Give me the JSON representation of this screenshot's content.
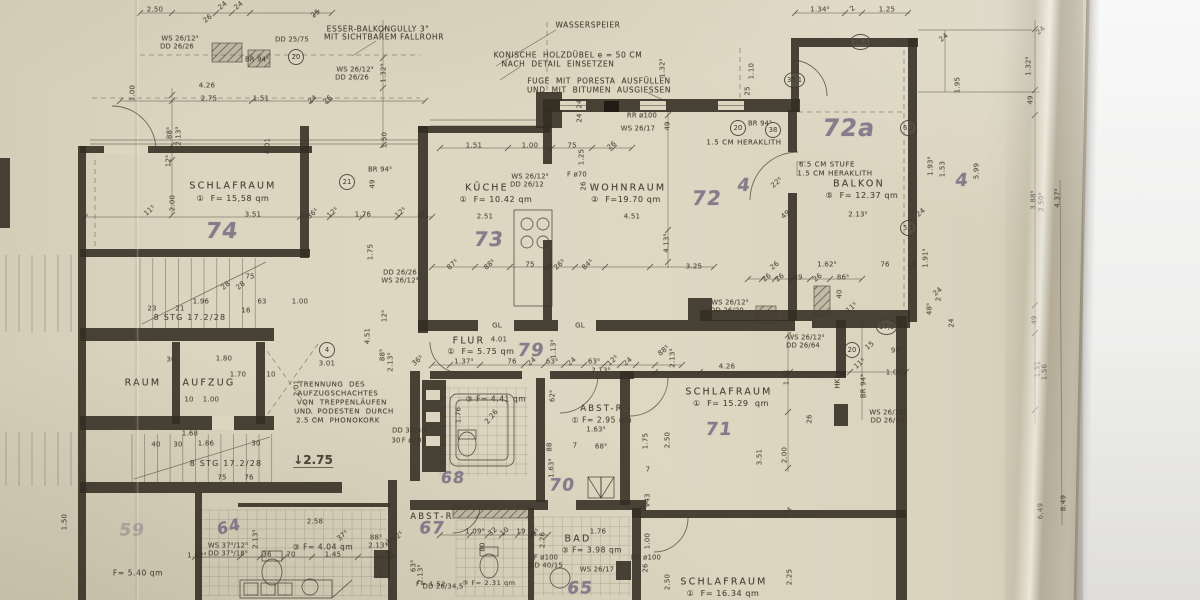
{
  "meta": {
    "title": "Grundriss — photographed hand-drawn German floor plan sheet (Obergeschoss apartment)"
  },
  "colors": {
    "paper": "#dcd5c0",
    "ink": "#3e372c",
    "pencil": "#6d647d",
    "background": "#efefee"
  },
  "rooms": [
    {
      "name": "SCHLAFRAUM",
      "index": "1",
      "area": "F= 15,58 qm",
      "pencil_no": "74"
    },
    {
      "name": "KÜCHE",
      "index": "1",
      "area": "F= 10.42 qm",
      "pencil_no": "73"
    },
    {
      "name": "WOHNRAUM",
      "index": "2",
      "area": "F= 19.70 qm",
      "pencil_no": "72"
    },
    {
      "name": "BALKON",
      "index": "5",
      "area": "F= 12.37 qm",
      "pencil_no": "72a"
    },
    {
      "name": "FLUR",
      "index": "1",
      "area": "F= 5.75 qm",
      "pencil_no": "79"
    },
    {
      "name": "SCHLAFRAUM",
      "index": "1",
      "area": "F= 15.29 qm",
      "pencil_no": "71"
    },
    {
      "name": "ABST-R",
      "index": "1",
      "area": "F= 2.95 qm",
      "pencil_no": ""
    },
    {
      "name": "BAD",
      "index": "3",
      "area": "F= 3.98 qm",
      "pencil_no": "65"
    },
    {
      "name": "SCHLAFRAUM",
      "index": "1",
      "area": "F= 16.34 qm",
      "pencil_no": ""
    },
    {
      "name": "AUFZUG",
      "index": "",
      "area": "",
      "pencil_no": ""
    },
    {
      "name": "RAUM",
      "index": "",
      "area": "",
      "pencil_no": ""
    },
    {
      "name": "ABST-R",
      "index": "",
      "area": "",
      "pencil_no": "67"
    },
    {
      "name": "BAD",
      "index": "3",
      "area": "F= 4.04 qm",
      "pencil_no": "64"
    }
  ],
  "labels": [
    [
      "ESSER-BALKONGULLY 3\"",
      378,
      29,
      0,
      7.5,
      "n"
    ],
    [
      "MIT SICHTBAREM FALLROHR",
      384,
      37,
      0,
      7.5,
      "n"
    ],
    [
      "WASSERSPEIER",
      588,
      25,
      0,
      7.5,
      "n"
    ],
    [
      "KONISCHE  HOLZDÜBEL e = 50 CM",
      568,
      55,
      0,
      7.5,
      "n"
    ],
    [
      "NACH  DETAIL  EINSETZEN",
      558,
      64,
      0,
      7.5,
      "n"
    ],
    [
      "FUGE  MIT  PORESTA  AUSFÜLLEN",
      599,
      81,
      0,
      7.5,
      "n"
    ],
    [
      "UND  MIT  BITUMEN  AUSGIESSEN",
      599,
      90,
      0,
      7.5,
      "n"
    ],
    [
      "1.5 CM HERAKLITH",
      744,
      143,
      0,
      7,
      "n"
    ],
    [
      "6.5 CM STUFE",
      827,
      165,
      0,
      7,
      "n"
    ],
    [
      "1.5 CM HERAKLITH",
      835,
      174,
      0,
      7,
      "n"
    ],
    [
      "TRENNUNG  DES",
      332,
      385,
      0,
      7,
      "n"
    ],
    [
      "AUFZUGSCHACHTES",
      338,
      394,
      0,
      7,
      "n"
    ],
    [
      "VON  TREPPENLÄUFEN",
      342,
      403,
      0,
      7,
      "n"
    ],
    [
      "UND  PODESTEN  DURCH",
      344,
      412,
      0,
      7,
      "n"
    ],
    [
      "2.5 CM  PHONOKORK",
      338,
      421,
      0,
      7,
      "n"
    ],
    [
      "WS 26/12⁵",
      180,
      39,
      0,
      6.8,
      "w"
    ],
    [
      "DD 26/26",
      177,
      47,
      0,
      6.8,
      "w"
    ],
    [
      "DD 25/75",
      292,
      40,
      0,
      6.8,
      "w"
    ],
    [
      "BR 94⁵",
      257,
      60,
      0,
      6.8,
      "w"
    ],
    [
      "WS 26/12⁵",
      355,
      70,
      0,
      6.8,
      "w"
    ],
    [
      "DD 26/26",
      352,
      78,
      0,
      6.8,
      "w"
    ],
    [
      "WS 26/12⁵",
      530,
      177,
      0,
      6.8,
      "w"
    ],
    [
      "DD 26/12",
      527,
      185,
      0,
      6.8,
      "w"
    ],
    [
      "F ø70",
      577,
      175,
      0,
      6.8,
      "w"
    ],
    [
      "RR ø100",
      642,
      116,
      0,
      6.8,
      "w"
    ],
    [
      "WS 26/17",
      638,
      129,
      0,
      6.8,
      "w"
    ],
    [
      "BR 94⁵",
      760,
      124,
      0,
      6.8,
      "w"
    ],
    [
      "BR 94⁵",
      380,
      170,
      0,
      6.8,
      "w"
    ],
    [
      "WS 26/12⁵",
      730,
      303,
      0,
      6.8,
      "w"
    ],
    [
      "DD 26/20",
      727,
      311,
      0,
      6.8,
      "w"
    ],
    [
      "WS 26/12⁵",
      806,
      338,
      0,
      6.8,
      "w"
    ],
    [
      "DD 26/64",
      803,
      346,
      0,
      6.8,
      "w"
    ],
    [
      "WS 26/12⁵",
      888,
      413,
      0,
      6.8,
      "w"
    ],
    [
      "DD 26/18⁵",
      889,
      421,
      0,
      6.8,
      "w"
    ],
    [
      "DD 26/26",
      400,
      273,
      0,
      6.8,
      "w"
    ],
    [
      "WS 26/12⁵",
      400,
      281,
      0,
      6.8,
      "w"
    ],
    [
      "DD 30/40",
      409,
      431,
      0,
      6.8,
      "w"
    ],
    [
      "30",
      396,
      441,
      0,
      6.8,
      "w"
    ],
    [
      "F ø100",
      414,
      441,
      0,
      6.8,
      "w"
    ],
    [
      "WS 37⁵/12⁵",
      228,
      546,
      0,
      6.8,
      "w"
    ],
    [
      "DD 37⁵/18⁵",
      228,
      554,
      0,
      6.8,
      "w"
    ],
    [
      "DD 26/34,5",
      443,
      587,
      0,
      6.8,
      "w"
    ],
    [
      "F ø100",
      546,
      558,
      0,
      6.8,
      "w"
    ],
    [
      "DD 40/15",
      546,
      566,
      0,
      6.8,
      "w"
    ],
    [
      "WS 26/17",
      597,
      570,
      0,
      6.8,
      "w"
    ],
    [
      "RR ø100",
      646,
      558,
      0,
      6.8,
      "w"
    ],
    [
      "HKN",
      838,
      381,
      -90,
      6.8,
      "w"
    ],
    [
      "BR 94⁵",
      864,
      386,
      -90,
      6.8,
      "w"
    ],
    [
      "GL",
      497,
      326,
      0,
      7,
      "w"
    ],
    [
      "GL",
      580,
      326,
      0,
      7,
      "w"
    ],
    [
      "8 STG 17.2/28",
      190,
      318,
      0,
      8,
      "stg"
    ],
    [
      "8 STG 17.2/28",
      226,
      464,
      0,
      8,
      "stg"
    ],
    [
      "↓2.75",
      313,
      461,
      0,
      12,
      "lvl"
    ],
    [
      "SCHLAFRAUM",
      233,
      186,
      0,
      9.5,
      "room"
    ],
    [
      "①  F= 15,58 qm",
      233,
      199,
      0,
      8,
      "area"
    ],
    [
      "KÜCHE",
      487,
      188,
      0,
      9.5,
      "room"
    ],
    [
      "①  F= 10.42 qm",
      496,
      200,
      0,
      8,
      "area"
    ],
    [
      "WOHNRAUM",
      628,
      188,
      0,
      9.5,
      "room"
    ],
    [
      "②  F=19.70 qm",
      626,
      200,
      0,
      8,
      "area"
    ],
    [
      "BALKON",
      859,
      184,
      0,
      9.5,
      "room"
    ],
    [
      "⑤  F= 12.37 qm",
      862,
      196,
      0,
      8,
      "area"
    ],
    [
      "FLUR",
      469,
      341,
      0,
      9.5,
      "room"
    ],
    [
      "①  F= 5.75 qm",
      481,
      352,
      0,
      8,
      "area"
    ],
    [
      "③ F= 4.41 qm",
      496,
      399,
      0,
      7.5,
      "area"
    ],
    [
      "ABST-R",
      602,
      409,
      0,
      8.5,
      "room"
    ],
    [
      "① F= 2.95 qm",
      602,
      420,
      0,
      7.5,
      "area"
    ],
    [
      "SCHLAFRAUM",
      729,
      392,
      0,
      9.5,
      "room"
    ],
    [
      "①  F= 15.29  qm",
      731,
      404,
      0,
      8,
      "area"
    ],
    [
      "RAUM",
      143,
      383,
      0,
      9.5,
      "room"
    ],
    [
      "AUFZUG",
      209,
      383,
      0,
      9.5,
      "room"
    ],
    [
      "ABST-R",
      432,
      517,
      0,
      8.5,
      "room"
    ],
    [
      "BAD",
      578,
      539,
      0,
      9.5,
      "room"
    ],
    [
      "③ F= 3.98 qm",
      592,
      550,
      0,
      7.5,
      "area"
    ],
    [
      "SCHLAFRAUM",
      724,
      582,
      0,
      9.5,
      "room"
    ],
    [
      "①  F= 16.34 qm",
      723,
      594,
      0,
      8,
      "area"
    ],
    [
      "③ F= 2.31 qm",
      489,
      583,
      0,
      6.5,
      "area"
    ],
    [
      "③ F= 4.04 qm",
      323,
      547,
      0,
      7.5,
      "area"
    ],
    [
      "F= 5.40 qm",
      138,
      573,
      0,
      7.5,
      "area"
    ],
    [
      "F= 1.52",
      431,
      584,
      0,
      6.5,
      "area"
    ],
    [
      "74",
      222,
      232,
      0,
      22,
      "hw"
    ],
    [
      "73",
      489,
      239,
      0,
      20,
      "hw"
    ],
    [
      "72",
      707,
      198,
      0,
      20,
      "hw"
    ],
    [
      "72a",
      849,
      128,
      0,
      24,
      "hw"
    ],
    [
      "79",
      531,
      351,
      0,
      18,
      "hw"
    ],
    [
      "71",
      719,
      430,
      0,
      18,
      "hw"
    ],
    [
      "70",
      562,
      486,
      0,
      17,
      "hw"
    ],
    [
      "68",
      453,
      478,
      0,
      16,
      "hw"
    ],
    [
      "67",
      432,
      529,
      0,
      17,
      "hw"
    ],
    [
      "65",
      580,
      589,
      0,
      17,
      "hw"
    ],
    [
      "64",
      229,
      527,
      -14,
      16,
      "hw"
    ],
    [
      "59",
      132,
      531,
      0,
      17,
      "hw2"
    ],
    [
      "4",
      744,
      186,
      0,
      18,
      "hw"
    ],
    [
      "4",
      962,
      181,
      0,
      18,
      "hw"
    ],
    [
      "2.50",
      155,
      10
    ],
    [
      "26",
      208,
      19,
      -40
    ],
    [
      "24",
      223,
      6,
      -40
    ],
    [
      "24",
      239,
      6,
      -40
    ],
    [
      "25",
      316,
      14,
      -40
    ],
    [
      "1.32⁵",
      384,
      73,
      -90
    ],
    [
      "4.26",
      207,
      86
    ],
    [
      "1.00",
      133,
      93,
      -90
    ],
    [
      "2.75",
      209,
      99
    ],
    [
      "1.51",
      261,
      99
    ],
    [
      "24",
      313,
      100,
      -40
    ],
    [
      "26",
      328,
      100,
      -40
    ],
    [
      "1.32⁵",
      663,
      68,
      -90
    ],
    [
      "1.10",
      752,
      71,
      -90
    ],
    [
      "25",
      748,
      91,
      -90
    ],
    [
      "24",
      580,
      104,
      -90
    ],
    [
      "24",
      580,
      118,
      -90
    ],
    [
      "49",
      668,
      126,
      -90
    ],
    [
      "1.34⁵",
      820,
      10
    ],
    [
      "2",
      853,
      9,
      -40
    ],
    [
      "1.25",
      887,
      10
    ],
    [
      "24",
      944,
      38,
      -40
    ],
    [
      "24",
      1041,
      31,
      -40
    ],
    [
      "1.32⁵",
      1029,
      66,
      -90
    ],
    [
      "1.95",
      958,
      85,
      -90
    ],
    [
      "1.93⁵",
      931,
      166,
      -90
    ],
    [
      "1.53",
      943,
      169,
      -90
    ],
    [
      "5.99",
      977,
      171,
      -90
    ],
    [
      "24",
      921,
      213,
      -40
    ],
    [
      "1.91⁵",
      926,
      258,
      -90
    ],
    [
      "24",
      938,
      292,
      -40
    ],
    [
      "48⁵",
      930,
      309,
      -90
    ],
    [
      "2",
      939,
      299,
      -90
    ],
    [
      "24",
      952,
      323,
      -90
    ],
    [
      "49",
      1031,
      100,
      -90
    ],
    [
      "3.88⁵",
      1034,
      200,
      -90
    ],
    [
      "2.50⁵",
      1042,
      202,
      -90
    ],
    [
      "4.37⁵",
      1058,
      198,
      -90
    ],
    [
      "49",
      1035,
      320,
      -90
    ],
    [
      "1.51",
      1038,
      369,
      -90
    ],
    [
      "1.56",
      1045,
      372,
      -90
    ],
    [
      "8.49",
      1064,
      503,
      -90
    ],
    [
      "6.49",
      1041,
      511,
      -90
    ],
    [
      "88⁵",
      170,
      133,
      -90
    ],
    [
      "2.13⁵",
      179,
      136,
      -90
    ],
    [
      "12⁵",
      169,
      161,
      -90
    ],
    [
      "4.01",
      268,
      146,
      -90
    ],
    [
      "2.00",
      173,
      203,
      -90
    ],
    [
      "11⁵",
      150,
      211,
      -40
    ],
    [
      "3.51",
      253,
      215
    ],
    [
      "36⁵",
      313,
      214,
      -40
    ],
    [
      "12⁵",
      333,
      213,
      -40
    ],
    [
      "1.76",
      363,
      215
    ],
    [
      "12⁵",
      401,
      213,
      -40
    ],
    [
      "36⁵",
      424,
      214,
      -40
    ],
    [
      "1.50",
      385,
      140,
      -90
    ],
    [
      "49",
      373,
      184,
      -90
    ],
    [
      "1.75",
      371,
      252,
      -90
    ],
    [
      "1.51",
      474,
      146
    ],
    [
      "1.00",
      530,
      146
    ],
    [
      "75",
      572,
      146
    ],
    [
      "26",
      612,
      146,
      -40
    ],
    [
      "1.25",
      582,
      157,
      -90
    ],
    [
      "26",
      584,
      186,
      -90
    ],
    [
      "2.51",
      485,
      217
    ],
    [
      "4.51",
      632,
      217
    ],
    [
      "4.13⁵",
      667,
      243,
      -90
    ],
    [
      "3.25",
      694,
      267
    ],
    [
      "87⁵",
      453,
      265,
      -40
    ],
    [
      "88⁵",
      490,
      265,
      -40
    ],
    [
      "75",
      530,
      265
    ],
    [
      "26⁵",
      560,
      265,
      -40
    ],
    [
      "84⁵",
      588,
      265,
      -40
    ],
    [
      "49",
      786,
      215,
      -40
    ],
    [
      "22⁵",
      777,
      183,
      -40
    ],
    [
      "2.13⁵",
      858,
      215
    ],
    [
      "26",
      775,
      266,
      -40
    ],
    [
      "1.62⁵",
      827,
      265
    ],
    [
      "76",
      885,
      265
    ],
    [
      "24",
      913,
      266,
      -40
    ],
    [
      "26",
      767,
      278,
      -40
    ],
    [
      "26",
      780,
      278,
      -40
    ],
    [
      "49",
      798,
      278
    ],
    [
      "26",
      818,
      278,
      -40
    ],
    [
      "86⁵",
      843,
      278
    ],
    [
      "40",
      840,
      294,
      -90
    ],
    [
      "11⁵",
      852,
      308,
      -40
    ],
    [
      "15",
      870,
      346,
      -40
    ],
    [
      "98⁵",
      897,
      351
    ],
    [
      "1.00",
      894,
      373
    ],
    [
      "11⁵",
      860,
      364,
      -40
    ],
    [
      "1.51",
      787,
      377,
      -90
    ],
    [
      "4.26",
      727,
      367
    ],
    [
      "23",
      152,
      309
    ],
    [
      "21",
      180,
      309
    ],
    [
      "16",
      246,
      311
    ],
    [
      "75",
      250,
      277
    ],
    [
      "28",
      226,
      286,
      -40
    ],
    [
      "28",
      241,
      286,
      -40
    ],
    [
      "1.96",
      201,
      302
    ],
    [
      "63",
      262,
      302
    ],
    [
      "1.00",
      300,
      302
    ],
    [
      "30",
      171,
      360
    ],
    [
      "1.80",
      224,
      359
    ],
    [
      "1.70",
      238,
      375
    ],
    [
      "10",
      271,
      375
    ],
    [
      "10",
      189,
      400
    ],
    [
      "1.00",
      211,
      400
    ],
    [
      "2.01",
      297,
      388,
      -90
    ],
    [
      "1.68",
      190,
      434
    ],
    [
      "1.86",
      206,
      444
    ],
    [
      "30",
      256,
      444
    ],
    [
      "40",
      156,
      445
    ],
    [
      "30",
      178,
      445
    ],
    [
      "75",
      222,
      478
    ],
    [
      "76",
      249,
      478
    ],
    [
      "12⁵",
      385,
      316,
      -90
    ],
    [
      "4.51",
      368,
      336,
      -90
    ],
    [
      "88⁵",
      383,
      355,
      -90
    ],
    [
      "2.13⁵",
      391,
      362,
      -90
    ],
    [
      "4.01",
      499,
      340
    ],
    [
      "3.01",
      327,
      364
    ],
    [
      "1.37⁵",
      464,
      362
    ],
    [
      "76",
      512,
      362
    ],
    [
      "24",
      532,
      362,
      -40
    ],
    [
      "63⁵",
      552,
      362
    ],
    [
      "24",
      572,
      362,
      -40
    ],
    [
      "63⁵",
      594,
      362
    ],
    [
      "12⁵",
      613,
      361,
      -40
    ],
    [
      "24",
      628,
      362,
      -40
    ],
    [
      "2.13⁵",
      601,
      371
    ],
    [
      "1.13⁵",
      554,
      349,
      -90
    ],
    [
      "36⁵",
      418,
      361,
      -40
    ],
    [
      "88⁵",
      664,
      351,
      -40
    ],
    [
      "2.13⁵",
      673,
      358,
      -90
    ],
    [
      "62⁵",
      553,
      396,
      -90
    ],
    [
      "88",
      550,
      447,
      -90
    ],
    [
      "7",
      575,
      446
    ],
    [
      "68⁵",
      601,
      447
    ],
    [
      "1.63⁵",
      596,
      430
    ],
    [
      "1.63⁵",
      552,
      468,
      -90
    ],
    [
      "1.76",
      459,
      415,
      -90
    ],
    [
      "2.26",
      492,
      417,
      -50
    ],
    [
      "1.75",
      646,
      441,
      -90
    ],
    [
      "2.50",
      668,
      440,
      -90
    ],
    [
      "7",
      648,
      470
    ],
    [
      "43",
      648,
      498,
      -90
    ],
    [
      "3.51",
      760,
      457,
      -90
    ],
    [
      "2.00",
      785,
      455,
      -90
    ],
    [
      "26",
      810,
      419,
      -90
    ],
    [
      "24",
      646,
      507,
      -40
    ],
    [
      "24",
      788,
      512,
      -40
    ],
    [
      "2.58",
      315,
      522
    ],
    [
      "36",
      267,
      555
    ],
    [
      "70",
      291,
      555
    ],
    [
      "1.45",
      333,
      555
    ],
    [
      "1.76",
      390,
      546,
      -90
    ],
    [
      "2.13⁵",
      256,
      539,
      -90
    ],
    [
      "1.62⁵",
      197,
      556
    ],
    [
      "1.50",
      65,
      522,
      -90
    ],
    [
      "37⁵",
      343,
      536,
      -40
    ],
    [
      "88⁵",
      376,
      538
    ],
    [
      "2.13⁵",
      378,
      546
    ],
    [
      "12⁵",
      398,
      537,
      -40
    ],
    [
      "63⁵",
      414,
      566,
      -90
    ],
    [
      "2.13⁵",
      421,
      574,
      -90
    ],
    [
      "1.09⁵",
      475,
      532
    ],
    [
      "32",
      493,
      532,
      -40
    ],
    [
      "10",
      505,
      532,
      -40
    ],
    [
      "19",
      521,
      532
    ],
    [
      "9⁵",
      536,
      533,
      -40
    ],
    [
      "80",
      483,
      547,
      -90
    ],
    [
      "2.26",
      543,
      540,
      -90
    ],
    [
      "1.76",
      598,
      532
    ],
    [
      "1.00",
      648,
      541,
      -90
    ],
    [
      "26",
      646,
      568,
      -90
    ],
    [
      "2.50",
      668,
      582,
      -90
    ],
    [
      "2.25",
      790,
      577,
      -90
    ]
  ],
  "bubbles": [
    [
      "20",
      296,
      57
    ],
    [
      "21",
      347,
      182
    ],
    [
      "20",
      738,
      128
    ],
    [
      "38",
      773,
      130
    ],
    [
      "35,1",
      792,
      80
    ],
    [
      "39,1",
      858,
      42
    ],
    [
      "6,2",
      908,
      128
    ],
    [
      "5,1",
      908,
      228
    ],
    [
      "17,1",
      884,
      327
    ],
    [
      "20",
      852,
      350
    ],
    [
      "4",
      327,
      350
    ]
  ]
}
